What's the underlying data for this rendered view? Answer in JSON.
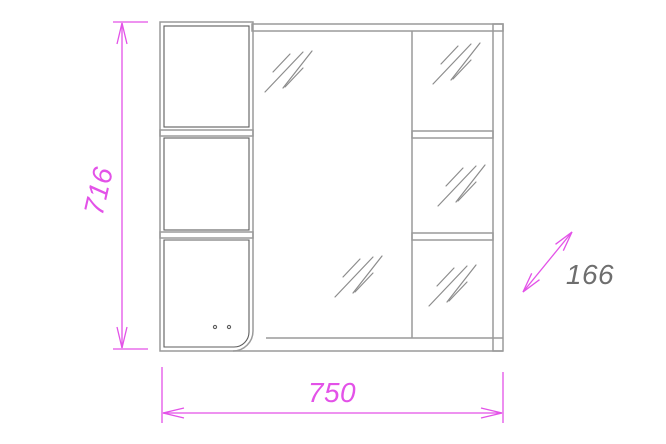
{
  "drawing": {
    "dimensions": {
      "height_mm": "716",
      "width_mm": "750",
      "depth_mm": "166"
    },
    "colors": {
      "dimension_accent": "#e352e8",
      "outline_gray": "#9a9a9a",
      "door_gray": "#5c5c5c",
      "hatch_gray": "#8c8c8c",
      "depth_text_gray": "#6e6e6e",
      "background": "#ffffff"
    },
    "symbols": {
      "glass_hatch": "double-diagonal-glass-mark"
    }
  }
}
